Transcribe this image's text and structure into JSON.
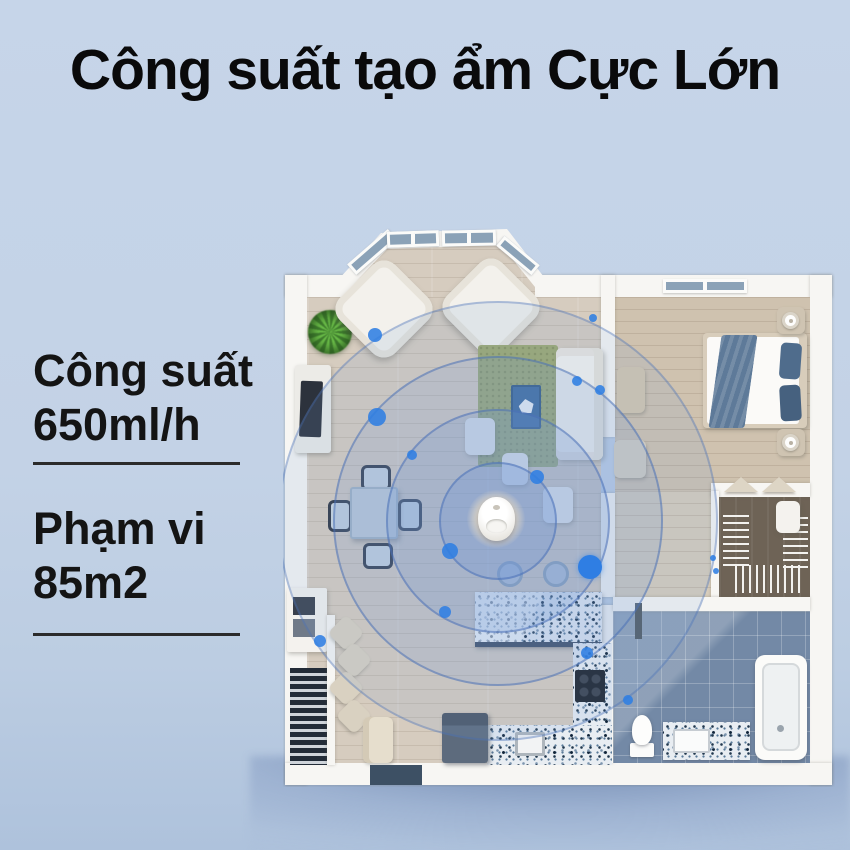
{
  "title": "Công suất tạo ẩm Cực Lớn",
  "specs": [
    {
      "label": "Công suất",
      "value": "650ml/h"
    },
    {
      "label": "Phạm vi",
      "value": "85m2"
    }
  ],
  "diagram": {
    "type": "floorplan-coverage",
    "device": "humidifier",
    "coverage_rings": 4,
    "rooms": [
      "living-room",
      "bedroom",
      "walk-in-closet",
      "bathroom",
      "kitchen",
      "stairs",
      "entry"
    ]
  },
  "colors": {
    "page_bg": "#c6d5e9",
    "title_text": "#0a0a0b",
    "accent_dot": "#2f7ee3",
    "ring_stroke": "#466cb4",
    "wood_floor": "#d6ccbf",
    "tile_floor": "#7389a6",
    "wall": "#f7f6f3"
  }
}
